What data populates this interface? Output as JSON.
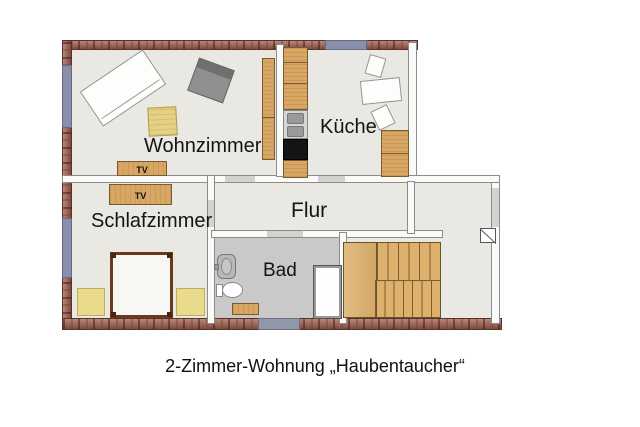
{
  "caption": "2-Zimmer-Wohnung „Haubentaucher“",
  "rooms": {
    "wohnzimmer": {
      "label": "Wohnzimmer"
    },
    "kueche": {
      "label": "Küche"
    },
    "schlafzimmer": {
      "label": "Schlafzimmer"
    },
    "flur": {
      "label": "Flur"
    },
    "bad": {
      "label": "Bad"
    }
  },
  "furniture_labels": {
    "tv_living": "TV",
    "tv_bedroom": "TV"
  },
  "colors": {
    "brick_wall": "#9b5a49",
    "window_blue": "#8a90ab",
    "window_gray": "#9097a9",
    "floor": "#e9e8e3",
    "bath_floor": "#c9c9c9",
    "interior_wall": "#fafaf8",
    "door_gap": "#d2d2d0",
    "wood": "#d8a763",
    "stairs_wood": "#ddb06c",
    "pale_yellow": "#e9da8c",
    "armchair_gray": "#8f8f8f",
    "stove_black": "#141414",
    "sink_gray": "#9a9a9a",
    "text": "#141414"
  }
}
